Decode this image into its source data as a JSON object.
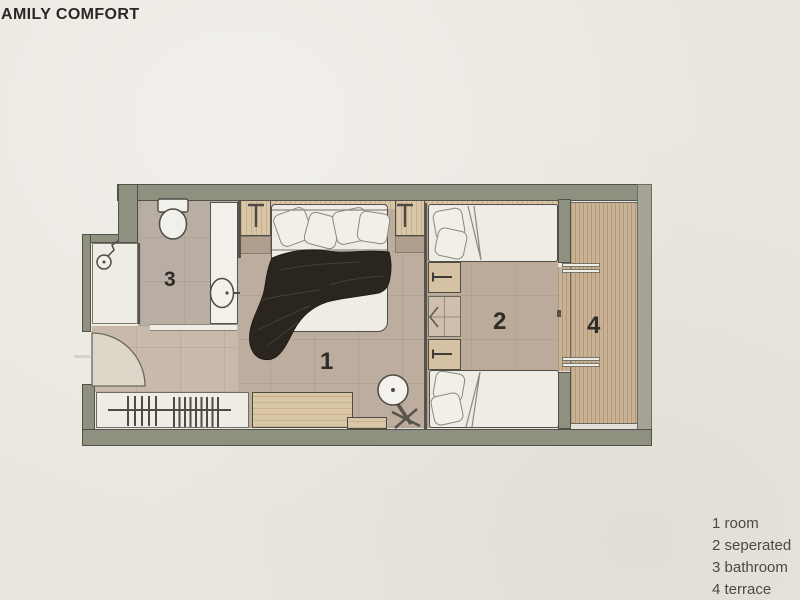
{
  "title": "AMILY COMFORT",
  "plan": {
    "room_labels": [
      "1",
      "2",
      "3",
      "4"
    ]
  },
  "legend": {
    "items": [
      "1 room",
      "2 seperated",
      "3 bathroom",
      "4 terrace"
    ]
  },
  "palette": {
    "background": "#ebe7e0",
    "wall": "#8e9180",
    "wall_light": "#a4a496",
    "outline": "#4c4b43",
    "floor_tan": "#bdad9e",
    "floor_bathroom": "#b8aea3",
    "floor_hall": "#c8b9ab",
    "wood_light": "#d9c6a7",
    "wood_terrace": "#c9b294",
    "white_fixture": "#f2f0ea",
    "blanket": "#2a251e",
    "label_text": "#2e2d29",
    "legend_text": "#4a4944"
  },
  "icons": [
    "door-swing-icon",
    "toilet-icon",
    "sink-icon",
    "shower-head-icon",
    "clothes-rail-icon",
    "wall-lamp-icon",
    "round-table-icon",
    "folding-chair-icon",
    "sliding-door-chevron-icon"
  ]
}
